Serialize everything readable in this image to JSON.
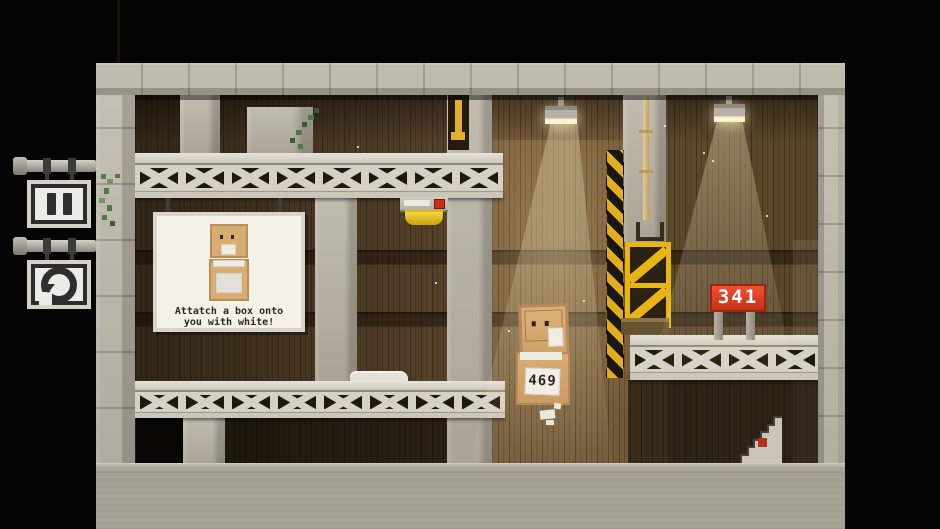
{
  "game": {
    "hud": {
      "pause_icon": "pause-icon",
      "restart_icon": "restart-icon"
    },
    "tutorial_sign": {
      "line1": "Attatch a box onto",
      "line2": "you with white!"
    },
    "player": {
      "box_number": "469"
    },
    "counter_sign": {
      "value": "341"
    }
  },
  "colors": {
    "background": "#000000",
    "concrete": "#c3bdb1",
    "wood_dark": "#4a3822",
    "wood_lit": "#b08a54",
    "hazard_yellow": "#e2ae1c",
    "counter_red": "#e0421f",
    "cardboard": "#d7ab72",
    "light_glow": "#fdf3cf"
  }
}
